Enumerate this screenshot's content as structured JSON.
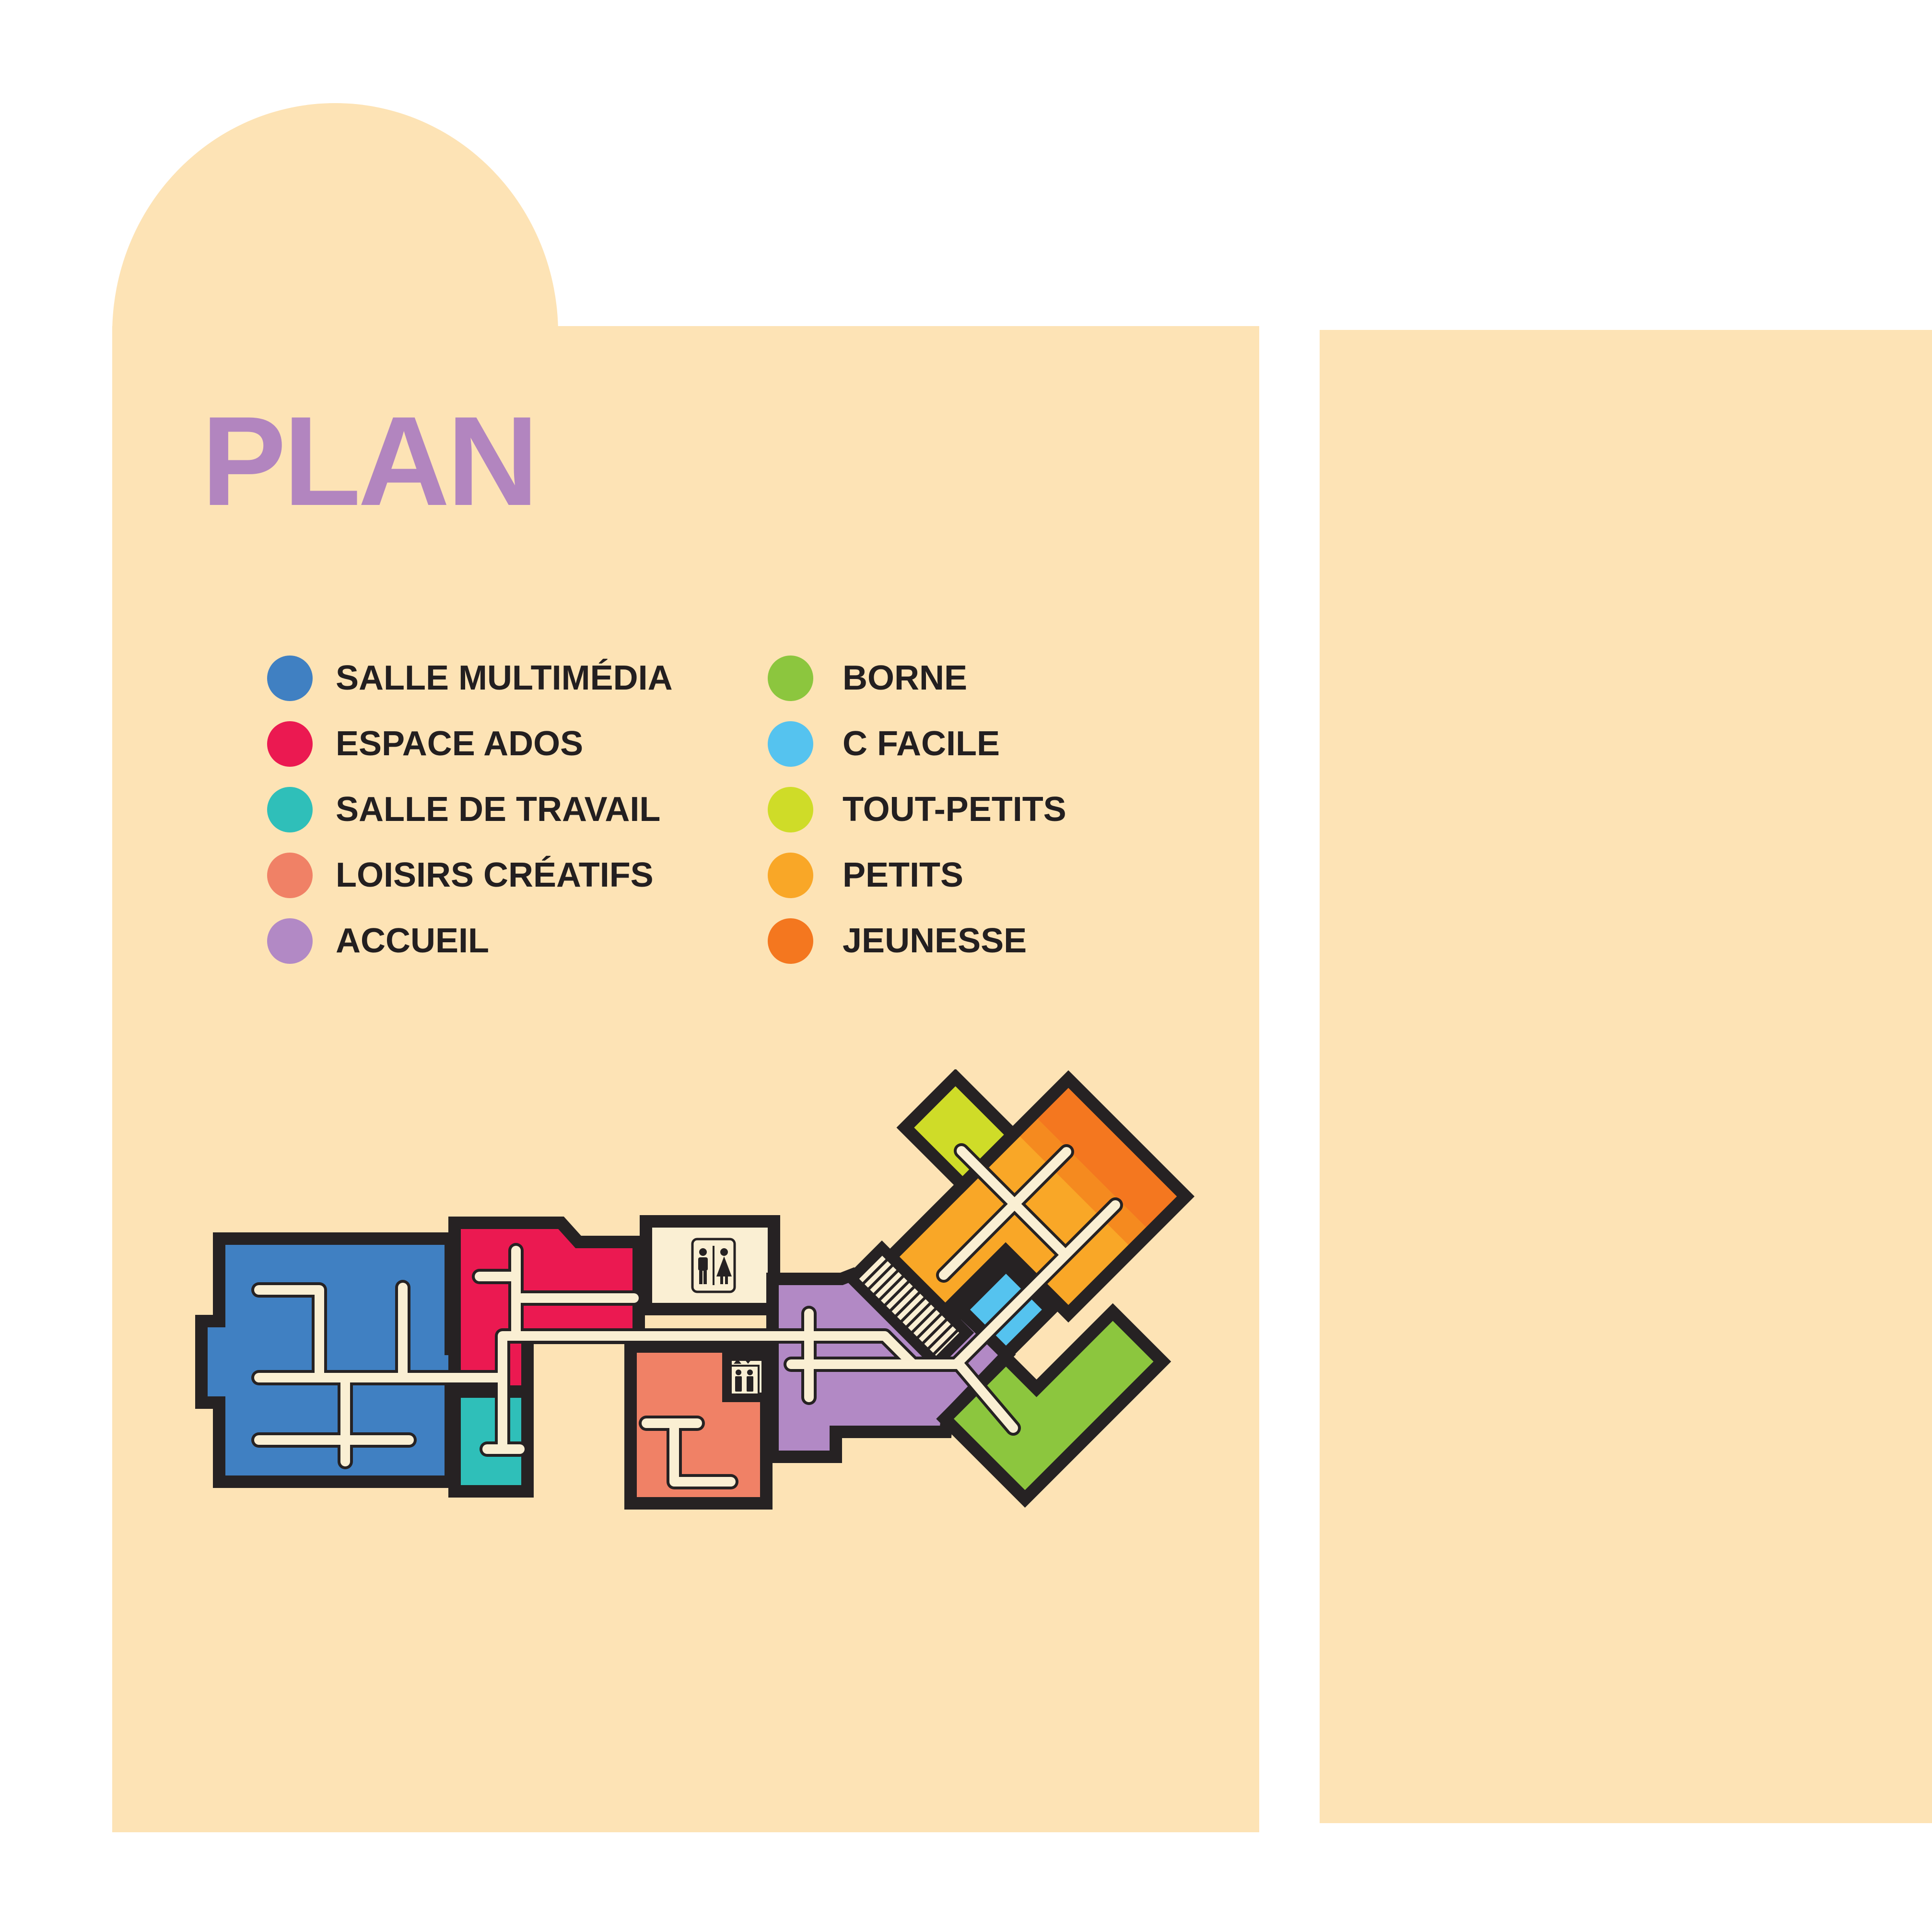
{
  "title": {
    "text": "PLAN",
    "color": "#B285BF"
  },
  "panel": {
    "background_color": "#FDE3B5"
  },
  "legend": {
    "col1": [
      {
        "label": "SALLE MULTIMÉDIA",
        "color": "#4080C2"
      },
      {
        "label": "ESPACE ADOS",
        "color": "#EB1951"
      },
      {
        "label": "SALLE DE TRAVAIL",
        "color": "#2FBFB9"
      },
      {
        "label": "LOISIRS CRÉATIFS",
        "color": "#F08166"
      },
      {
        "label": "ACCUEIL",
        "color": "#B289C5"
      }
    ],
    "col2": [
      {
        "label": "BORNE",
        "color": "#8CC63E"
      },
      {
        "label": "C FACILE",
        "color": "#55C3EF"
      },
      {
        "label": "TOUT-PETITS",
        "color": "#CFDC28"
      },
      {
        "label": "PETITS",
        "color": "#F9A727"
      },
      {
        "label": "JEUNESSE",
        "color": "#F4771F"
      }
    ]
  },
  "plan": {
    "wall_color": "#262223",
    "corridor_color": "#FAEFD3",
    "room_mid_orange_color": "#F58A1F",
    "icons": [
      "wc-sign",
      "elevator-sign",
      "staircase"
    ]
  }
}
